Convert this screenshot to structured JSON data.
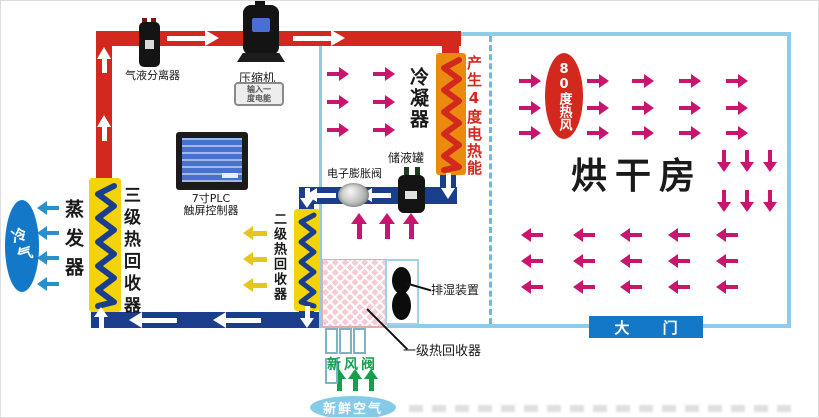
{
  "components": {
    "separator": "气液分离器",
    "compressor": "压缩机",
    "compressor_stamp": [
      "输入一",
      "度电能"
    ],
    "plc": [
      "7寸PLC",
      "触屏控制器"
    ],
    "condenser": "冷凝器",
    "electric_heat": "产生4度电热能",
    "tank": "储液罐",
    "expansion_valve": "电子膨胀阀",
    "evaporator": "蒸发器",
    "stage3_recovery": "三级热回收器",
    "stage2_recovery": "二级热回收器",
    "stage1_recovery": "一级热回收器",
    "dehumidifier": "排湿装置",
    "fresh_air_valve": "新风阀",
    "drying_room": "烘干房",
    "door": "大 门",
    "cold_air": "冷气",
    "fresh_air": "新鲜空气",
    "hot_wind": "80度热风"
  },
  "colors": {
    "hot_pipe": "#d3281e",
    "cold_pipe": "#1a3e8c",
    "wall": "#8dcdea",
    "coil_yellow": "#f3d40a",
    "coil_orange": "#ea8a0e",
    "hot_air_arrow": "#c9156d",
    "cold_air_arrow": "#2a90cc",
    "recovered_heat_arrow": "#e6c51c",
    "fresh_air_arrow": "#12a04a",
    "oval_blue": "#1478c8",
    "oval_light_blue": "#85cbe8",
    "oval_red": "#d3281e",
    "door_bg": "#1478c8"
  },
  "arrows": [
    {
      "name": "hot-air-right",
      "dir": "right",
      "color": "#c9156d",
      "len": 22,
      "stroke": 4,
      "head": 10,
      "halfw": 7,
      "x": [
        518,
        586,
        631,
        678,
        725
      ],
      "y": [
        80,
        107,
        132
      ]
    },
    {
      "name": "hot-air-down",
      "dir": "down",
      "color": "#c9156d",
      "len": 22,
      "stroke": 4,
      "head": 10,
      "halfw": 7,
      "x": [
        723,
        746,
        769
      ],
      "y": [
        149,
        189
      ]
    },
    {
      "name": "return-air-left",
      "dir": "left",
      "color": "#c9156d",
      "len": 22,
      "stroke": 4,
      "head": 10,
      "halfw": 7,
      "x": [
        520,
        572,
        619,
        667,
        715
      ],
      "y": [
        234,
        260,
        286
      ]
    },
    {
      "name": "condenser-air-right",
      "dir": "right",
      "color": "#c9156d",
      "len": 22,
      "stroke": 4,
      "head": 10,
      "halfw": 7,
      "x": [
        326,
        372
      ],
      "y": [
        73,
        101,
        129
      ]
    },
    {
      "name": "rising-hot-air-up",
      "dir": "up",
      "color": "#c9156d",
      "len": 26,
      "stroke": 5,
      "head": 11,
      "halfw": 8,
      "x": [
        358,
        386,
        410
      ],
      "y": [
        212
      ]
    },
    {
      "name": "cold-air-left",
      "dir": "left",
      "color": "#2a90cc",
      "len": 22,
      "stroke": 4,
      "head": 10,
      "halfw": 7,
      "x": [
        36
      ],
      "y": [
        207,
        232,
        257,
        283
      ]
    },
    {
      "name": "stage2-heat-left",
      "dir": "left",
      "color": "#e6c51c",
      "len": 24,
      "stroke": 5,
      "head": 10,
      "halfw": 7,
      "x": [
        242
      ],
      "y": [
        232,
        258,
        284
      ]
    },
    {
      "name": "fresh-air-up",
      "dir": "up",
      "color": "#12a04a",
      "len": 22,
      "stroke": 5,
      "head": 10,
      "halfw": 7,
      "x": [
        338,
        354,
        370
      ],
      "y": [
        368
      ]
    },
    {
      "name": "pipe-hot-flow-right",
      "dir": "right",
      "color": "#ffffff",
      "len": 52,
      "stroke": 5,
      "head": 14,
      "halfw": 8,
      "x": [
        166,
        292
      ],
      "y": [
        37
      ]
    },
    {
      "name": "pipe-hot-flow-up",
      "dir": "up",
      "color": "#ffffff",
      "len": 26,
      "stroke": 5,
      "head": 12,
      "halfw": 7,
      "x": [
        103
      ],
      "y": [
        46,
        114
      ]
    },
    {
      "name": "pipe-liquid-flow-left",
      "dir": "left",
      "color": "#ffffff",
      "len": 30,
      "stroke": 5,
      "head": 11,
      "halfw": 7,
      "x": [
        305,
        360
      ],
      "y": [
        194
      ]
    },
    {
      "name": "pipe-into-condenser-down",
      "dir": "down",
      "color": "#ffffff",
      "len": 26,
      "stroke": 5,
      "head": 11,
      "halfw": 7,
      "x": [
        447
      ],
      "y": [
        172
      ]
    },
    {
      "name": "pipe-into-coil2-down",
      "dir": "down",
      "color": "#ffffff",
      "len": 20,
      "stroke": 5,
      "head": 10,
      "halfw": 7,
      "x": [
        306
      ],
      "y": [
        187
      ]
    },
    {
      "name": "pipe-return-flow-left",
      "dir": "left",
      "color": "#ffffff",
      "len": 48,
      "stroke": 5,
      "head": 13,
      "halfw": 8,
      "x": [
        128,
        212
      ],
      "y": [
        319
      ]
    },
    {
      "name": "pipe-up-into-evaporator",
      "dir": "up",
      "color": "#ffffff",
      "len": 22,
      "stroke": 5,
      "head": 10,
      "halfw": 7,
      "x": [
        100
      ],
      "y": [
        306
      ]
    },
    {
      "name": "pipe-down-from-coil2",
      "dir": "down",
      "color": "#ffffff",
      "len": 22,
      "stroke": 5,
      "head": 10,
      "halfw": 7,
      "x": [
        306
      ],
      "y": [
        305
      ]
    }
  ]
}
